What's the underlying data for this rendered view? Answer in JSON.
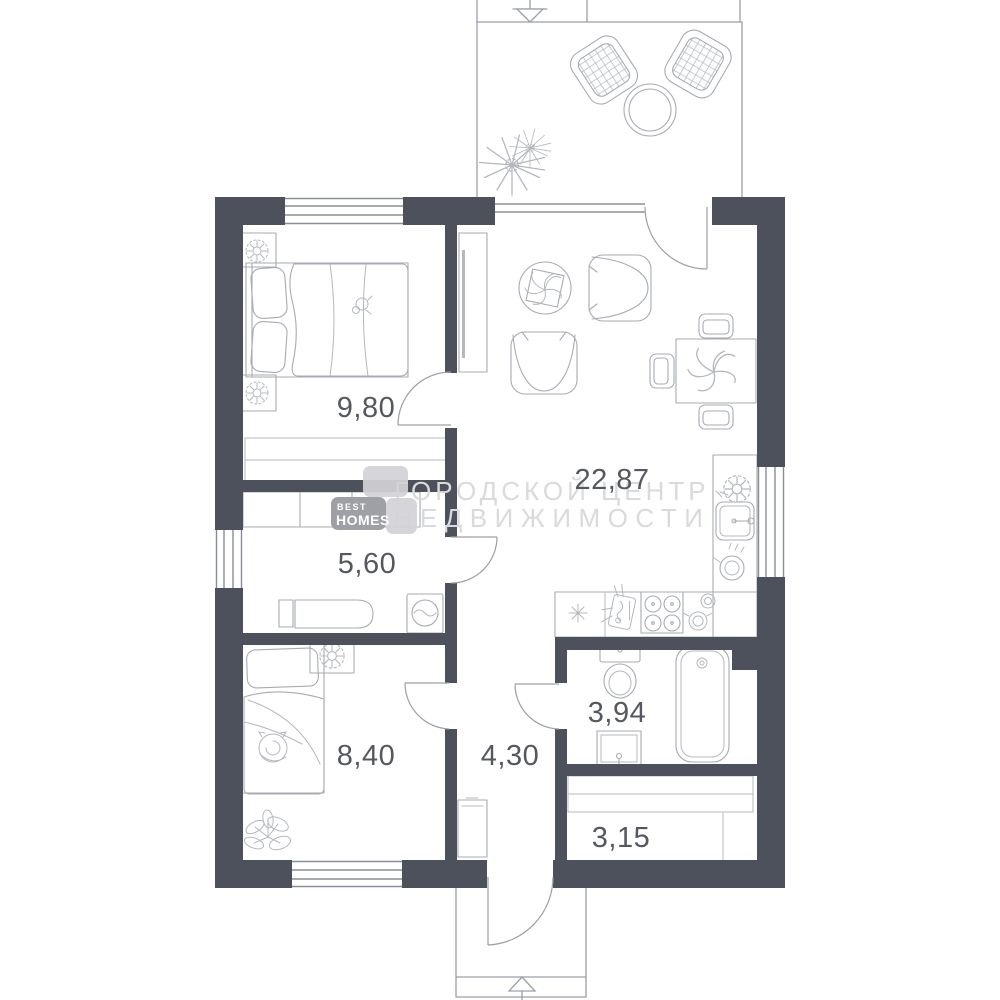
{
  "rooms": {
    "bedroom_main": {
      "area": "9,80"
    },
    "living_kitchen": {
      "area": "22,87"
    },
    "laundry": {
      "area": "5,60"
    },
    "bedroom_second": {
      "area": "8,40"
    },
    "hallway": {
      "area": "4,30"
    },
    "bathroom": {
      "area": "3,94"
    },
    "wardrobe": {
      "area": "3,15"
    }
  },
  "watermark": {
    "line1": "ГОРОДСКОЙ ЦЕНТР",
    "line2": "НЕДВИЖИМОСТИ"
  },
  "logo": {
    "top": "BEST",
    "bottom": "HOMES"
  },
  "colors": {
    "wall": "#4c515c",
    "fixture_line": "#a7abb2",
    "outline_line": "#9aa0a8",
    "label_text": "#55585f",
    "watermark_text": "#d9dadc",
    "logo_main": "#9ea0a6",
    "logo_light": "#d2d3d7"
  }
}
